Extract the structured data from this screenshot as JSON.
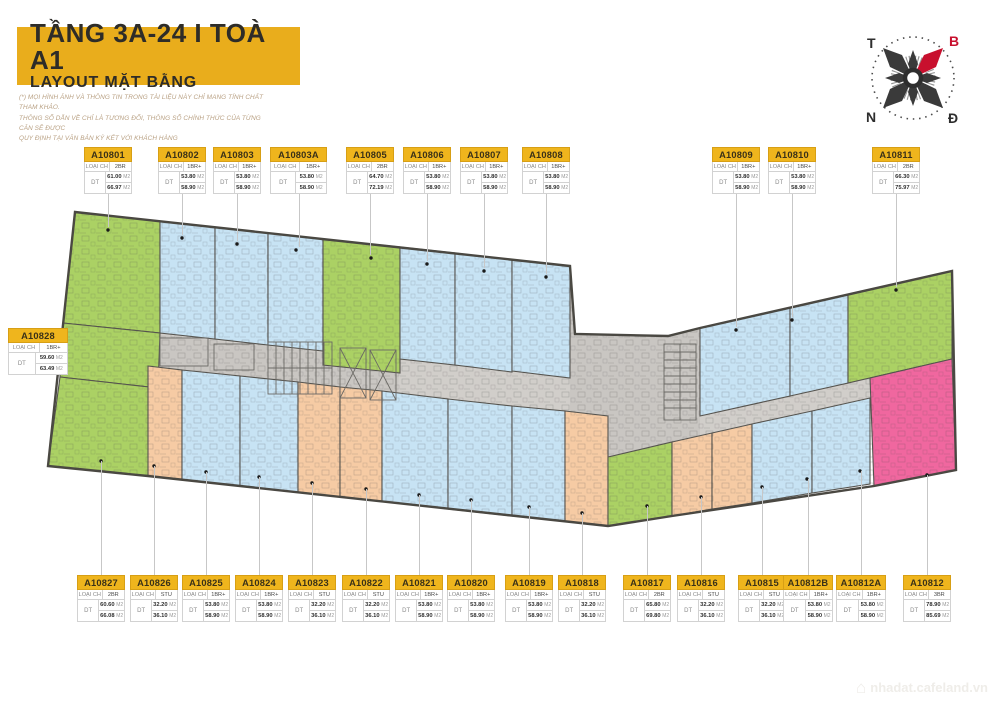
{
  "header": {
    "title": "TẦNG 3A-24  I  TOÀ A1",
    "subtitle": "LAYOUT MẶT BẰNG"
  },
  "disclaimer": {
    "line1": "(*) MỌI HÌNH ẢNH VÀ THÔNG TIN TRONG TÀI LIỆU NÀY CHỈ MANG TÍNH CHẤT THAM KHẢO.",
    "line2": "THÔNG SỐ DẪN VỀ CHỈ LÀ TƯƠNG ĐỐI, THÔNG SỐ CHÍNH THỨC CỦA TỪNG CĂN SẼ ĐƯỢC",
    "line3": "QUY ĐỊNH TẠI VĂN BẢN KÝ KẾT VỚI KHÁCH HÀNG"
  },
  "compass": {
    "west": "T",
    "north": "B",
    "south": "N",
    "east": "Đ"
  },
  "labels": {
    "type": "LOẠI CH",
    "area": "DT",
    "unit": "M2"
  },
  "units_top": [
    {
      "id": "A10801",
      "type": "2BR",
      "area1": "61.00",
      "area2": "66.97"
    },
    {
      "id": "A10802",
      "type": "1BR+",
      "area1": "53.80",
      "area2": "58.90"
    },
    {
      "id": "A10803",
      "type": "1BR+",
      "area1": "53.80",
      "area2": "58.90"
    },
    {
      "id": "A10803A",
      "type": "1BR+",
      "area1": "53.80",
      "area2": "58.90"
    },
    {
      "id": "A10805",
      "type": "2BR",
      "area1": "64.70",
      "area2": "72.19"
    },
    {
      "id": "A10806",
      "type": "1BR+",
      "area1": "53.80",
      "area2": "58.90"
    },
    {
      "id": "A10807",
      "type": "1BR+",
      "area1": "53.80",
      "area2": "58.90"
    },
    {
      "id": "A10808",
      "type": "1BR+",
      "area1": "53.80",
      "area2": "58.90"
    },
    {
      "id": "A10809",
      "type": "1BR+",
      "area1": "53.80",
      "area2": "58.90"
    },
    {
      "id": "A10810",
      "type": "1BR+",
      "area1": "53.80",
      "area2": "58.90"
    },
    {
      "id": "A10811",
      "type": "2BR",
      "area1": "66.30",
      "area2": "75.97"
    }
  ],
  "unit_left": {
    "id": "A10828",
    "type": "1BR+",
    "area1": "59.60",
    "area2": "63.49"
  },
  "units_bottom": [
    {
      "id": "A10827",
      "type": "2BR",
      "area1": "60.60",
      "area2": "66.08"
    },
    {
      "id": "A10826",
      "type": "STU",
      "area1": "32.20",
      "area2": "36.10"
    },
    {
      "id": "A10825",
      "type": "1BR+",
      "area1": "53.80",
      "area2": "58.90"
    },
    {
      "id": "A10824",
      "type": "1BR+",
      "area1": "53.80",
      "area2": "58.90"
    },
    {
      "id": "A10823",
      "type": "STU",
      "area1": "32.20",
      "area2": "36.10"
    },
    {
      "id": "A10822",
      "type": "STU",
      "area1": "32.20",
      "area2": "36.10"
    },
    {
      "id": "A10821",
      "type": "1BR+",
      "area1": "53.80",
      "area2": "58.90"
    },
    {
      "id": "A10820",
      "type": "1BR+",
      "area1": "53.80",
      "area2": "58.90"
    },
    {
      "id": "A10819",
      "type": "1BR+",
      "area1": "53.80",
      "area2": "58.90"
    },
    {
      "id": "A10818",
      "type": "STU",
      "area1": "32.20",
      "area2": "36.10"
    },
    {
      "id": "A10817",
      "type": "2BR",
      "area1": "65.80",
      "area2": "69.80"
    },
    {
      "id": "A10816",
      "type": "STU",
      "area1": "32.20",
      "area2": "36.10"
    },
    {
      "id": "A10815",
      "type": "STU",
      "area1": "32.20",
      "area2": "36.10"
    },
    {
      "id": "A10812B",
      "type": "1BR+",
      "area1": "53.80",
      "area2": "58.90"
    },
    {
      "id": "A10812A",
      "type": "1BR+",
      "area1": "53.80",
      "area2": "58.90"
    },
    {
      "id": "A10812",
      "type": "3BR",
      "area1": "78.90",
      "area2": "85.69"
    }
  ],
  "watermark": "nhadat.cafeland.vn",
  "colors": {
    "banner_yellow": "#E9AD1C",
    "card_yellow": "#EFB51D",
    "unit_blue": "#C7E3F4",
    "unit_green": "#ABD164",
    "unit_orange": "#F6CBA4",
    "unit_pink": "#F0679F",
    "corridor_gray": "#D1CECA",
    "wall": "#55534F",
    "compass_red": "#C8102E"
  }
}
